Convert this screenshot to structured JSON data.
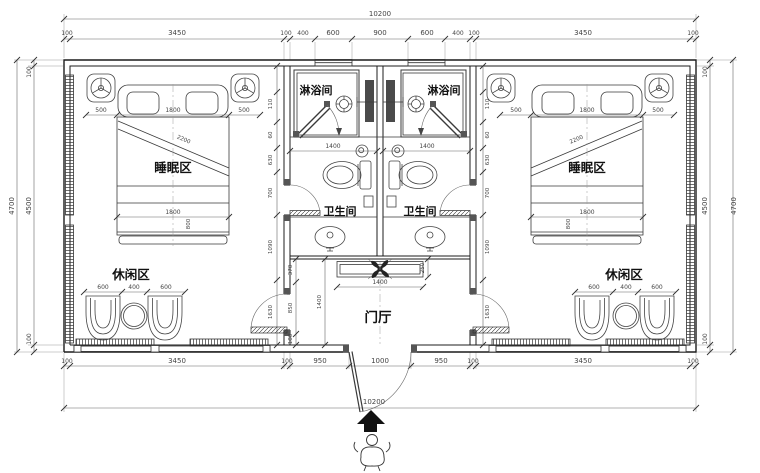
{
  "labels": {
    "shower": "淋浴间",
    "toilet": "卫生间",
    "sleep": "睡眠区",
    "leisure": "休闲区",
    "hall": "门厅"
  },
  "dims": {
    "total": "10200",
    "top": [
      "100",
      "3450",
      "100",
      "400",
      "600",
      "900",
      "600",
      "400",
      "100",
      "3450",
      "100"
    ],
    "bottom": [
      "100",
      "3450",
      "100",
      "950",
      "1000",
      "950",
      "100",
      "3450",
      "100"
    ],
    "side_outer": "4700",
    "side_chain": [
      "100",
      "4500",
      "100"
    ],
    "bed": [
      "500",
      "1800",
      "500"
    ],
    "bed_len": "1800",
    "bed_diag": "2200",
    "bed_foot": "800",
    "chairs": [
      "600",
      "400",
      "600"
    ],
    "bath_w": "1400",
    "counter_w": "1400",
    "hall": {
      "top": "370",
      "mid": "850",
      "height": "1400",
      "counter_d": "250",
      "bottom": "180"
    },
    "room_chain": [
      "110",
      "60",
      "630",
      "700",
      "1090",
      "1630"
    ]
  }
}
